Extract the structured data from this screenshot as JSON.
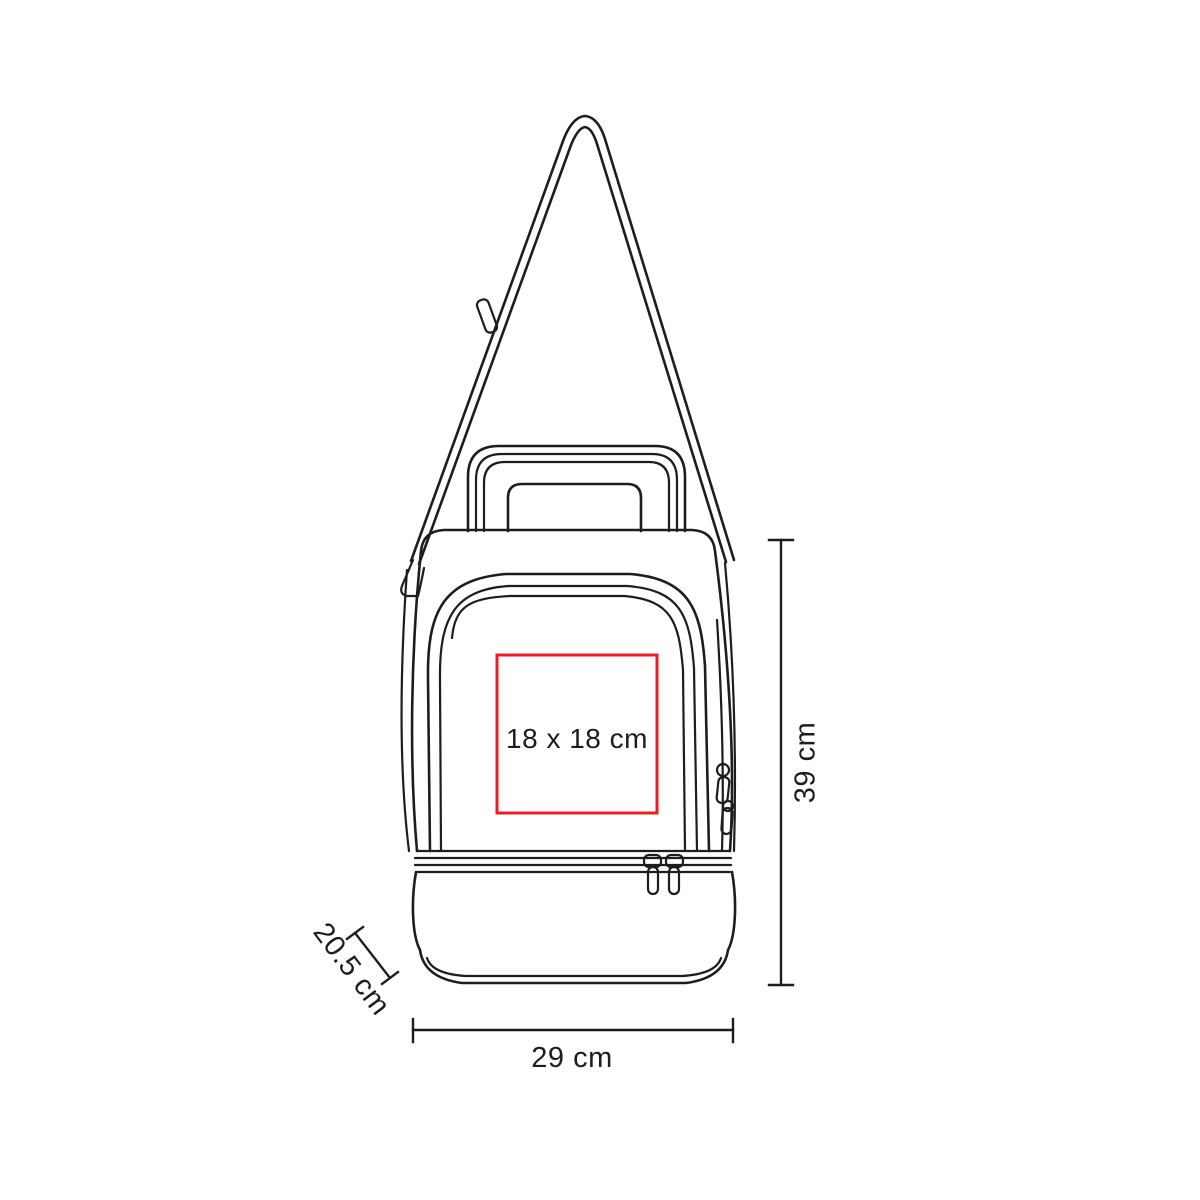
{
  "colors": {
    "line": "#1d1d1d",
    "imprint_red": "#ed1c24",
    "background": "#ffffff",
    "text": "#1d1d1d"
  },
  "product": {
    "imprint_area": {
      "label": "18 x 18 cm"
    },
    "dimensions": {
      "height": {
        "label": "39 cm"
      },
      "width": {
        "label": "29 cm"
      },
      "depth": {
        "label": "20.5 cm"
      }
    }
  }
}
